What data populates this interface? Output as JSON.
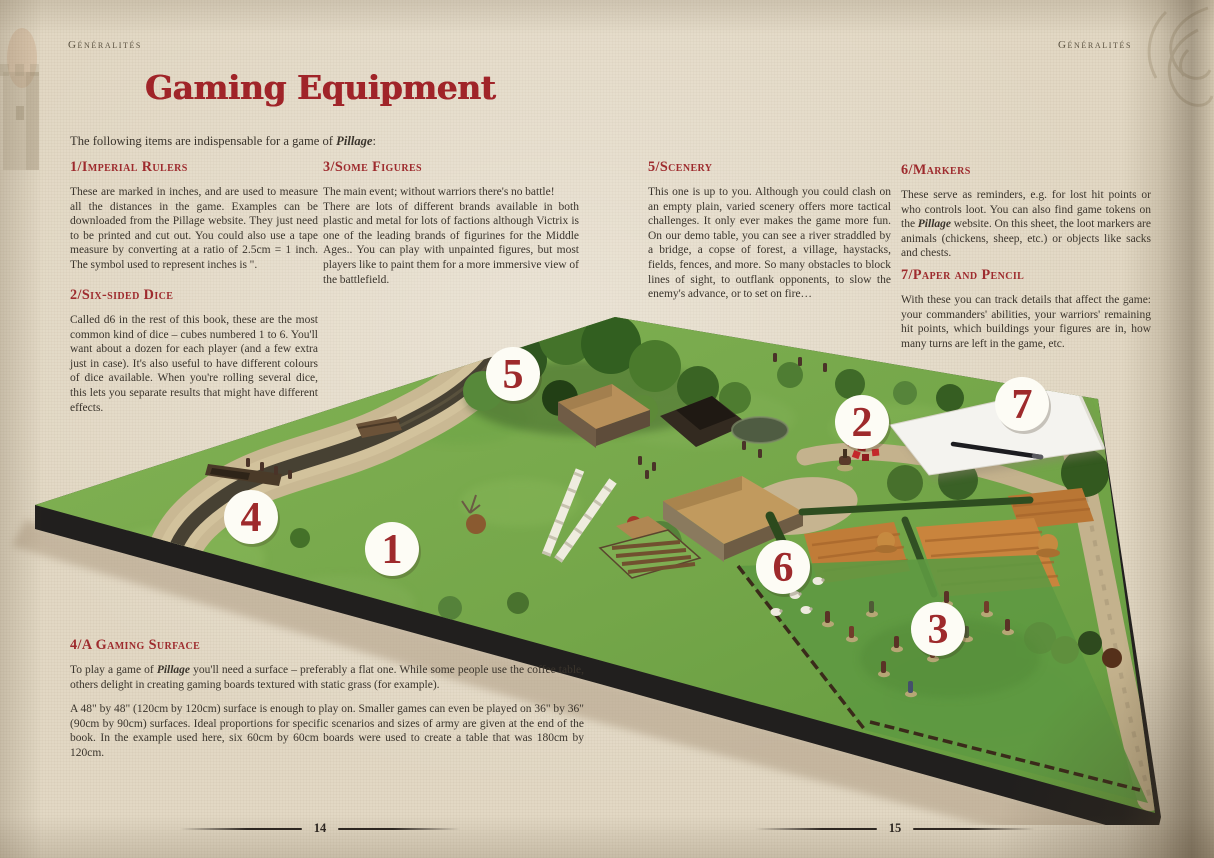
{
  "page": {
    "header_left": "Généralités",
    "header_right": "Généralités",
    "title": "Gaming Equipment",
    "page_number_left": "14",
    "page_number_right": "15"
  },
  "intro": {
    "pre": "The following items are indispensable for a game of ",
    "em": "Pillage",
    "post": ":"
  },
  "sections": {
    "rulers": {
      "num": "1/",
      "title": "Imperial Rulers",
      "body": "These are marked in inches, and are used to measure all the distances in the game. Examples can be downloaded from the Pillage website. They just need to be printed and cut out. You could also use a tape measure by converting at a ratio of 2.5cm = 1 inch. The symbol used to represent inches is \"."
    },
    "dice": {
      "num": "2/",
      "title": "Six-sided Dice",
      "body": "Called d6 in the rest of this book, these are the most common kind of dice – cubes numbered 1 to 6. You'll want about a dozen for each player (and a few extra just in case). It's also useful to have different colours of dice available. When you're rolling several dice, this lets you separate results that might have different effects."
    },
    "figures": {
      "num": "3/",
      "title": "Some Figures",
      "body_line1": "The main event; without warriors there's no battle!",
      "body_rest": "There are lots of different brands available in both plastic and metal for lots of factions although Victrix is one of the leading brands of figurines for the Middle Ages.. You can play with unpainted figures, but most players like to paint them for a more immersive view of the battlefield."
    },
    "scenery": {
      "num": "5/",
      "title": "Scenery",
      "body": "This one is up to you. Although you could clash on an empty plain, varied scenery offers more tactical challenges. It only ever makes the game more fun. On our demo table, you can see a river straddled by a bridge, a copse of forest, a village, haystacks, fields, fences, and more. So many obstacles to block lines of sight, to outflank opponents, to slow the enemy's advance, or to set on fire…"
    },
    "markers": {
      "num": "6/",
      "title": "Markers",
      "body_pre": "These serve as reminders, e.g. for lost hit points or who controls loot. You can also find game tokens on the ",
      "body_em": "Pillage",
      "body_post": " website. On this sheet, the loot markers are animals (chickens, sheep, etc.) or objects like sacks and chests."
    },
    "paper": {
      "num": "7/",
      "title": "Paper and Pencil",
      "body": "With these you can track details that affect the game: your commanders' abilities, your warriors' remaining hit points, which buildings your figures are in, how many turns are left in the game, etc."
    },
    "surface": {
      "num": "4/",
      "title": "A Gaming Surface",
      "para1_pre": "To play a game of ",
      "para1_em": "Pillage",
      "para1_post": " you'll need a surface – preferably a flat one. While some people use the coffee table, others delight in creating gaming boards textured with static grass (for example).",
      "para2": "A 48\" by 48\" (120cm by 120cm) surface is enough to play on. Smaller games can even be played on 36\" by 36\" (90cm by 90cm) surfaces. Ideal proportions for specific scenarios and sizes of army are given at the end of the book. In the example used here, six 60cm by 60cm boards were used to create a table that was 180cm by 120cm."
    }
  },
  "photo": {
    "description": "demo gaming table with river, bridge, copse of forest, village, haystacks, fields, fences, sheep and warrior figures",
    "markers": [
      {
        "label": "1",
        "x": 392,
        "y": 549
      },
      {
        "label": "2",
        "x": 862,
        "y": 422
      },
      {
        "label": "3",
        "x": 938,
        "y": 629
      },
      {
        "label": "4",
        "x": 251,
        "y": 517
      },
      {
        "label": "5",
        "x": 513,
        "y": 374
      },
      {
        "label": "6",
        "x": 783,
        "y": 567
      },
      {
        "label": "7",
        "x": 1022,
        "y": 404
      }
    ]
  },
  "colors": {
    "accent_red": "#9e2b2e",
    "title_red": "#a02429",
    "marker_number_red": "#9e2a2c",
    "marker_circle": "#fdfcf5",
    "body_text": "#3a342c",
    "parchment": "#e2d8c4",
    "table_green": "#74a649",
    "table_edge_black": "#211f1e"
  }
}
